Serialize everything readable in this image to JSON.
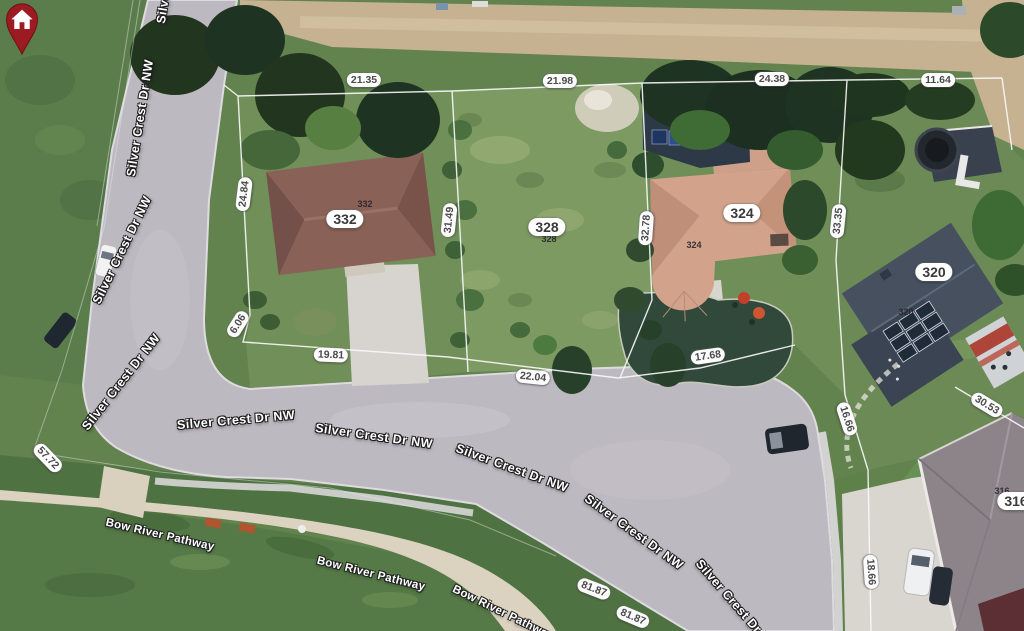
{
  "map": {
    "colors": {
      "pin_red": "#9c1b22",
      "badge_bg": "#ffffff",
      "badge_text": "#3a3a3a",
      "road_gray": "#bdb9c1",
      "grass_green": "#62824e",
      "alley_tan": "#c6b191",
      "pathway_tan": "#d8cfbc",
      "label_white": "#ffffff"
    },
    "pin": {
      "label": "328",
      "icon": "house-icon",
      "color": "#9c1b22"
    },
    "street_labels": [
      {
        "text": "Silver Crest Dr NW",
        "x": 170,
        "y": -35,
        "rot": -81
      },
      {
        "text": "Silver Crest Dr NW",
        "x": 140,
        "y": 118,
        "rot": -81
      },
      {
        "text": "Silver Crest Dr NW",
        "x": 122,
        "y": 250,
        "rot": -64
      },
      {
        "text": "Silver Crest Dr NW",
        "x": 121,
        "y": 382,
        "rot": -52
      },
      {
        "text": "Silver Crest Dr NW",
        "x": 236,
        "y": 420,
        "rot": -5
      },
      {
        "text": "Silver Crest Dr NW",
        "x": 374,
        "y": 436,
        "rot": 8
      },
      {
        "text": "Silver Crest Dr NW",
        "x": 512,
        "y": 468,
        "rot": 20
      },
      {
        "text": "Silver Crest Dr NW",
        "x": 634,
        "y": 532,
        "rot": 36
      },
      {
        "text": "Silver Crest Dr NW",
        "x": 737,
        "y": 606,
        "rot": 49
      }
    ],
    "path_labels": [
      {
        "text": "Bow River Pathway",
        "x": 160,
        "y": 535,
        "rot": 13
      },
      {
        "text": "Bow River Pathway",
        "x": 371,
        "y": 574,
        "rot": 14
      },
      {
        "text": "Bow River Pathway",
        "x": 503,
        "y": 613,
        "rot": 26
      }
    ],
    "dimension_labels": [
      {
        "text": "21.35",
        "x": 364,
        "y": 80,
        "rot": 0
      },
      {
        "text": "21.98",
        "x": 560,
        "y": 81,
        "rot": 0
      },
      {
        "text": "24.38",
        "x": 772,
        "y": 79,
        "rot": 0
      },
      {
        "text": "11.64",
        "x": 938,
        "y": 80,
        "rot": 0
      },
      {
        "text": "24.84",
        "x": 244,
        "y": 194,
        "rot": -83
      },
      {
        "text": "31.49",
        "x": 449,
        "y": 220,
        "rot": -84
      },
      {
        "text": "32.78",
        "x": 646,
        "y": 228,
        "rot": -86
      },
      {
        "text": "33.35",
        "x": 838,
        "y": 221,
        "rot": -84
      },
      {
        "text": "6.06",
        "x": 238,
        "y": 324,
        "rot": -58
      },
      {
        "text": "19.81",
        "x": 331,
        "y": 355,
        "rot": 2
      },
      {
        "text": "22.04",
        "x": 533,
        "y": 377,
        "rot": 6
      },
      {
        "text": "17.68",
        "x": 708,
        "y": 356,
        "rot": -8
      },
      {
        "text": "57.72",
        "x": 48,
        "y": 458,
        "rot": 46
      },
      {
        "text": "16.66",
        "x": 847,
        "y": 419,
        "rot": 72
      },
      {
        "text": "30.53",
        "x": 987,
        "y": 405,
        "rot": 31
      },
      {
        "text": "18.66",
        "x": 871,
        "y": 572,
        "rot": 86
      },
      {
        "text": "81.87",
        "x": 594,
        "y": 589,
        "rot": 21
      },
      {
        "text": "81.87",
        "x": 633,
        "y": 617,
        "rot": 23
      }
    ],
    "house_badges": [
      {
        "text": "332",
        "x": 345,
        "y": 219,
        "rot": 0
      },
      {
        "text": "324",
        "x": 742,
        "y": 213,
        "rot": 0
      },
      {
        "text": "320",
        "x": 934,
        "y": 272,
        "rot": 0
      },
      {
        "text": "328",
        "x": 547,
        "y": 227,
        "rot": 0
      },
      {
        "text": "316",
        "x": 1016,
        "y": 501,
        "rot": 0
      }
    ],
    "roof_labels": [
      {
        "text": "332",
        "x": 365,
        "y": 204,
        "rot": 0
      },
      {
        "text": "324",
        "x": 694,
        "y": 245,
        "rot": 0
      },
      {
        "text": "320",
        "x": 906,
        "y": 312,
        "rot": 0
      },
      {
        "text": "328",
        "x": 549,
        "y": 239,
        "rot": 0
      },
      {
        "text": "316",
        "x": 1002,
        "y": 491,
        "rot": 0
      }
    ]
  }
}
